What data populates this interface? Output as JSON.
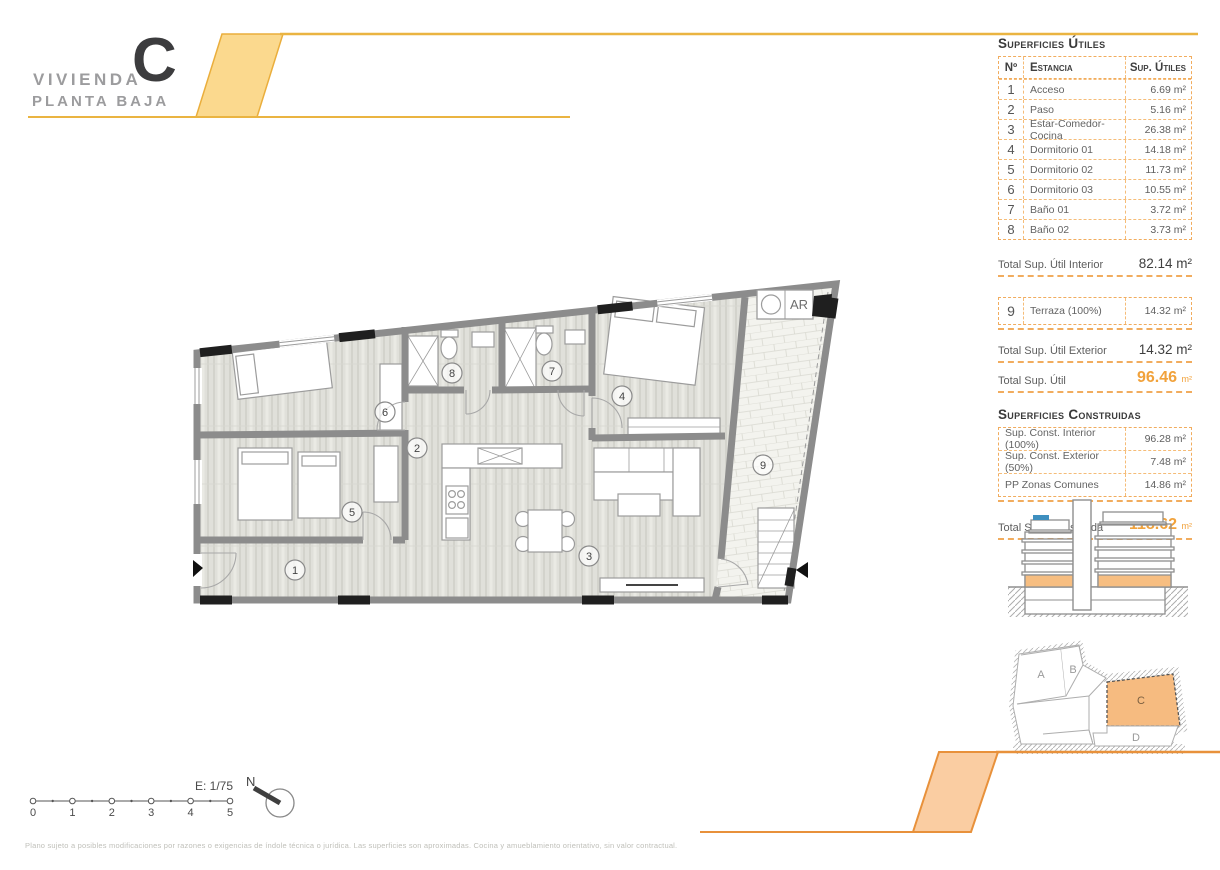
{
  "header": {
    "brand_small": "VIVIENDA",
    "brand_letter": "C",
    "brand_sub": "PLANTA BAJA"
  },
  "panel": {
    "utiles": {
      "heading": "Superficies Útiles",
      "col_num": "Nº",
      "col_room": "Estancia",
      "col_area": "Sup. Útiles",
      "rows": [
        {
          "num": "1",
          "room": "Acceso",
          "area": "6.69 m²"
        },
        {
          "num": "2",
          "room": "Paso",
          "area": "5.16 m²"
        },
        {
          "num": "3",
          "room": "Estar-Comedor-Cocina",
          "area": "26.38 m²"
        },
        {
          "num": "4",
          "room": "Dormitorio 01",
          "area": "14.18 m²"
        },
        {
          "num": "5",
          "room": "Dormitorio 02",
          "area": "11.73 m²"
        },
        {
          "num": "6",
          "room": "Dormitorio 03",
          "area": "10.55 m²"
        },
        {
          "num": "7",
          "room": "Baño 01",
          "area": "3.72 m²"
        },
        {
          "num": "8",
          "room": "Baño 02",
          "area": "3.73 m²"
        }
      ],
      "total_interior_label": "Total Sup. Útil Interior",
      "total_interior_value": "82.14 m²",
      "terraza": {
        "num": "9",
        "room": "Terraza (100%)",
        "area": "14.32 m²"
      },
      "total_exterior_label": "Total Sup. Útil Exterior",
      "total_exterior_value": "14.32 m²",
      "total_label": "Total Sup. Útil",
      "total_value": "96.46",
      "total_unit": "m²"
    },
    "construidas": {
      "heading": "Superficies Construidas",
      "rows": [
        {
          "room": "Sup. Const. Interior (100%)",
          "area": "96.28 m²"
        },
        {
          "room": "Sup. Const. Exterior (50%)",
          "area": "7.48 m²"
        },
        {
          "room": "PP Zonas Comunes",
          "area": "14.86 m²"
        }
      ],
      "total_label": "Total Sup. Construida",
      "total_value": "118.62",
      "total_unit": "m²"
    }
  },
  "plan": {
    "labels": {
      "r1": "1",
      "r2": "2",
      "r3": "3",
      "r4": "4",
      "r5": "5",
      "r6": "6",
      "r7": "7",
      "r8": "8",
      "r9": "9"
    },
    "closet": "AR"
  },
  "site": {
    "a": "A",
    "b": "B",
    "c": "C",
    "d": "D"
  },
  "footer": {
    "scale_label": "E: 1/75",
    "ticks": [
      "0",
      "1",
      "2",
      "3",
      "4",
      "5"
    ],
    "north": "N",
    "disclaimer": "Plano sujeto a posibles modificaciones por razones o exigencias de índole técnica o jurídica. Las superficies son aproximadas. Cocina y amueblamiento orientativo, sin valor contractual."
  },
  "colors": {
    "accent_yellow": "#EAB441",
    "accent_yellow_fill": "#FBD98E",
    "accent_orange": "#E8913B",
    "accent_orange_fill": "#FACDA2",
    "orange_text": "#F1A23B",
    "table_border": "#F1AC5E"
  }
}
